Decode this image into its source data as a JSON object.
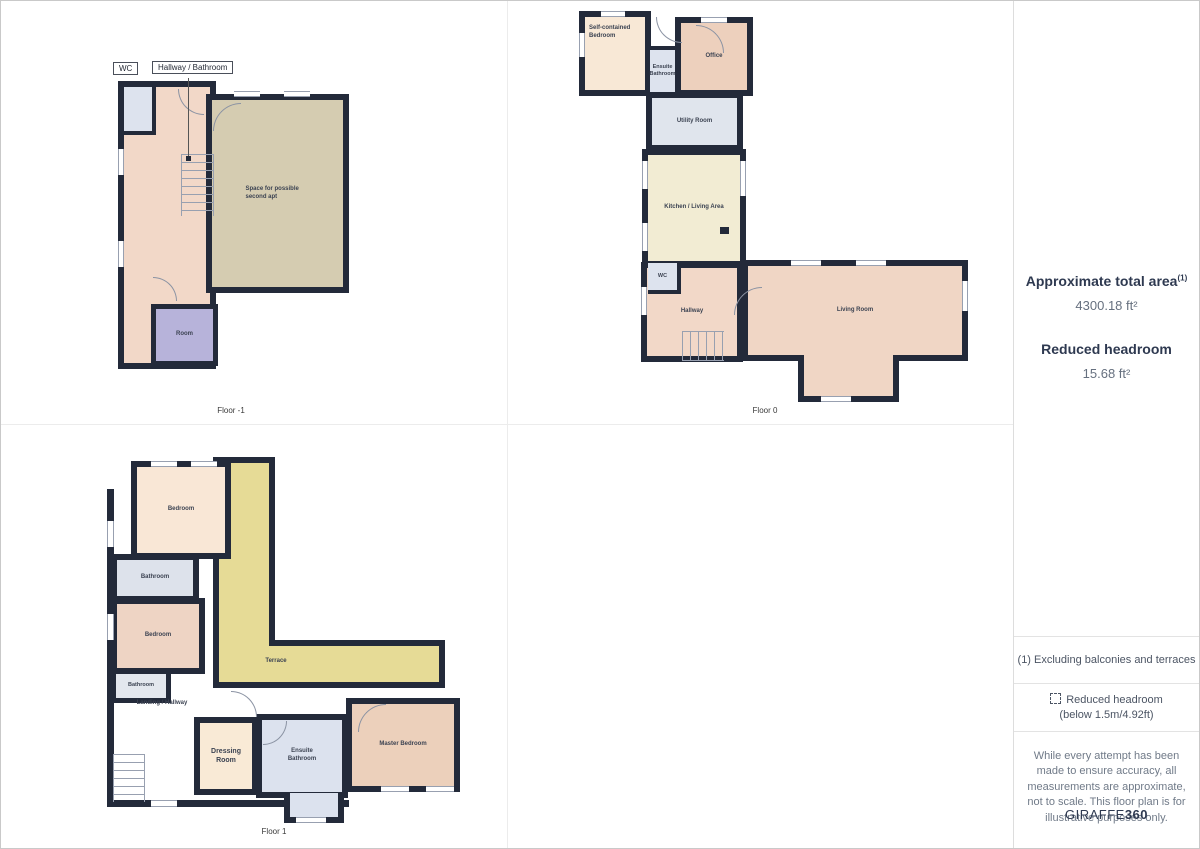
{
  "sidebar": {
    "total_area_label": "Approximate total area",
    "total_area_sup": "(1)",
    "total_area_value": "4300.18 ft²",
    "headroom_label": "Reduced headroom",
    "headroom_value": "15.68 ft²",
    "note_terraces": "(1) Excluding balconies and terraces",
    "note_headroom_line1": "Reduced headroom",
    "note_headroom_line2": "(below 1.5m/4.92ft)",
    "disclaimer": "While every attempt has been made to ensure accuracy, all measurements are approximate, not to scale. This floor plan is for illustrative purposes only.",
    "brand_name": "GIRAFFE",
    "brand_suffix": "360"
  },
  "floors": [
    {
      "caption": "Floor -1",
      "callouts": [
        "WC",
        "Hallway / Bathroom"
      ],
      "rooms": [
        {
          "label": "Space for possible second apt"
        },
        {
          "label": "Room"
        }
      ]
    },
    {
      "caption": "Floor 0",
      "rooms": [
        {
          "label": "Self-contained Bedroom"
        },
        {
          "label": "Ensuite Bathroom"
        },
        {
          "label": "Office"
        },
        {
          "label": "Utility Room"
        },
        {
          "label": "Kitchen / Living Area"
        },
        {
          "label": "WC"
        },
        {
          "label": "Hallway"
        },
        {
          "label": "Living Room"
        }
      ]
    },
    {
      "caption": "Floor 1",
      "rooms": [
        {
          "label": "Bedroom"
        },
        {
          "label": "Terrace"
        },
        {
          "label": "Bathroom"
        },
        {
          "label": "Bedroom"
        },
        {
          "label": "Bathroom"
        },
        {
          "label": "Landing / Hallway"
        },
        {
          "label": "Dressing Room"
        },
        {
          "label": "Ensuite Bathroom"
        },
        {
          "label": "Master Bedroom"
        }
      ]
    }
  ],
  "colors": {
    "wall": "#232a3a",
    "hall_peach": "#f2d8c8",
    "room_peach_dark": "#edd0bd",
    "bedroom_cream": "#f8e8d6",
    "kitchen_cream": "#f2ecd3",
    "second_apt_tan": "#d5ccb1",
    "basement_lavender": "#b7b3da",
    "bath_blue_gray": "#dde3ee",
    "terrace_yellow": "#e6db96"
  }
}
